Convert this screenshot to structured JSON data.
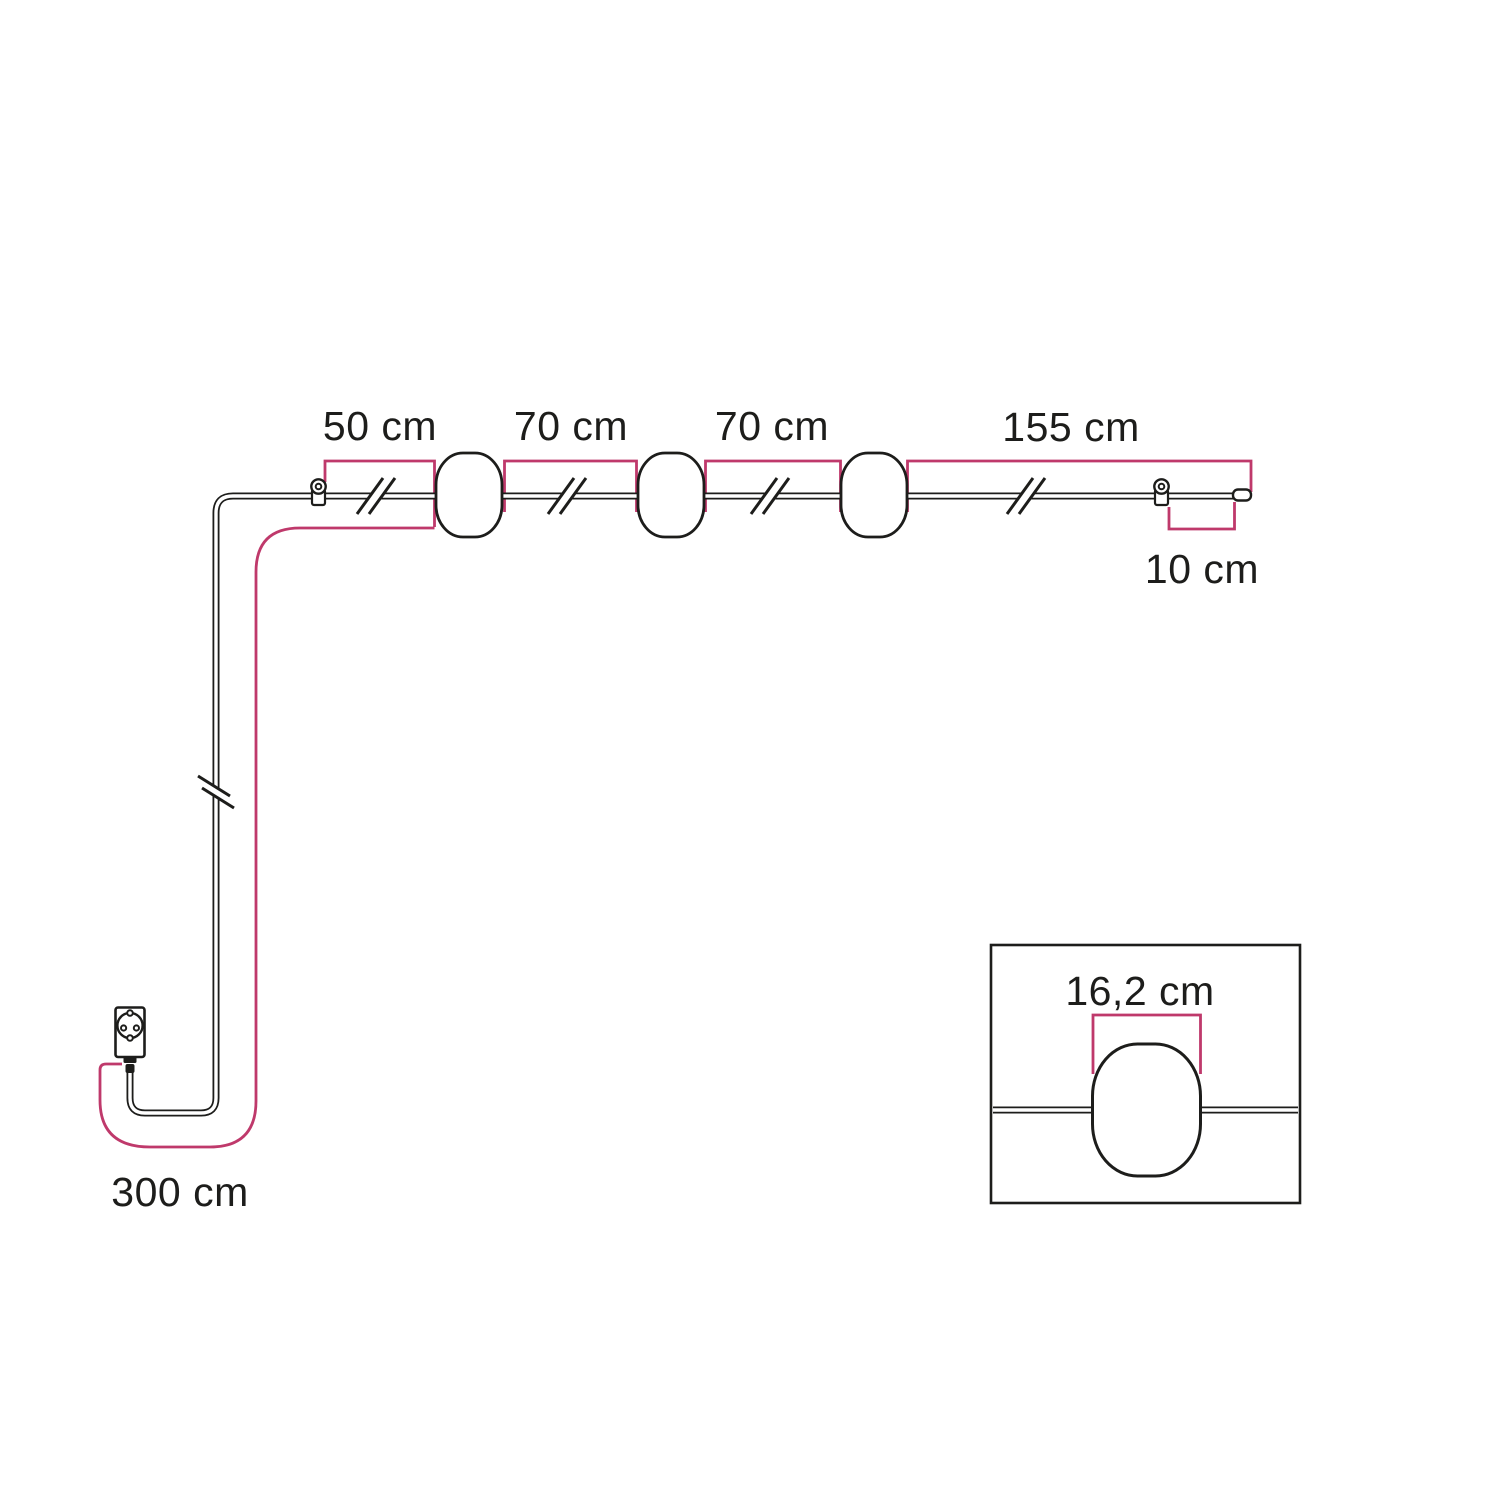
{
  "title": "String light cable dimension diagram",
  "colors": {
    "accent": "#bf396b",
    "line": "#1d1d1b",
    "text": "#1d1d1b",
    "background": "#ffffff"
  },
  "dimensions": [
    {
      "id": "segment-1",
      "label": "50 cm"
    },
    {
      "id": "segment-2",
      "label": "70 cm"
    },
    {
      "id": "segment-3",
      "label": "70 cm"
    },
    {
      "id": "segment-4",
      "label": "155 cm"
    },
    {
      "id": "end-tail",
      "label": "10 cm"
    },
    {
      "id": "power-lead",
      "label": "300 cm"
    },
    {
      "id": "lampshade-width",
      "label": "16,2 cm"
    }
  ],
  "components": {
    "lampshade_count": 3,
    "hook_count": 2,
    "icons": [
      "plug-icon",
      "hook-eyelet-icon",
      "lampshade-icon",
      "cable-break-icon",
      "cable-end-cap-icon",
      "lampshade-detail-inset"
    ]
  }
}
